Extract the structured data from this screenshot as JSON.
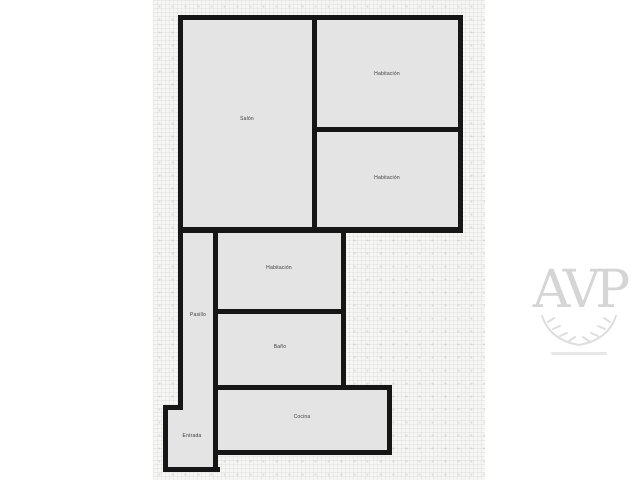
{
  "plan": {
    "type": "floor-plan",
    "rooms": [
      {
        "id": "salon",
        "label": "Salón"
      },
      {
        "id": "habitacion-top",
        "label": "Habitación"
      },
      {
        "id": "habitacion-bottom",
        "label": "Habitación"
      },
      {
        "id": "habitacion-middle",
        "label": "Habitación"
      },
      {
        "id": "pasillo",
        "label": "Pasillo"
      },
      {
        "id": "bano",
        "label": "Baño"
      },
      {
        "id": "cocina",
        "label": "Cocina"
      },
      {
        "id": "entrada",
        "label": "Entrada"
      }
    ],
    "watermark": {
      "text": "AVP"
    }
  },
  "colors": {
    "wall": "#161616",
    "room": "#e4e4e4",
    "canvas": "#f6f6f5",
    "page": "#ffffff",
    "label": "#3a3a3a",
    "watermark": "#cbcbcb"
  }
}
